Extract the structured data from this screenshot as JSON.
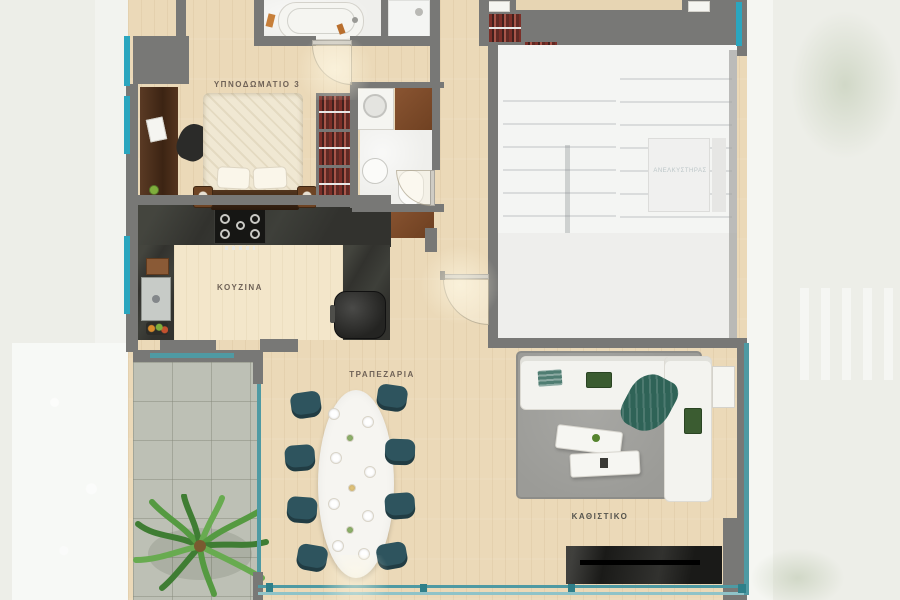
{
  "rooms": {
    "bedroom3": {
      "label": "ΥΠΝΟΔΩΜΑΤΙΟ 3"
    },
    "kitchen": {
      "label": "ΚΟΥΖΙΝΑ"
    },
    "dining": {
      "label": "ΤΡΑΠΕΖΑΡΙΑ"
    },
    "living": {
      "label": "ΚΑΘΙΣΤΙΚΟ"
    },
    "elevator": {
      "label": "ΑΝΕΛΚΥΣΤΗΡΑΣ"
    }
  },
  "colors": {
    "wood_floor": "#ebd9b8",
    "wall_gray": "#787876",
    "window_teal": "#2ba6bf",
    "window_teal_muted": "#4f9aa3",
    "kitchen_counter": "#2e2e2a",
    "dining_chair_teal": "#2e545e",
    "rug_gray": "#9b9b97",
    "terrace_tile": "#bdc0b5",
    "pool_water": "#dcedf2",
    "outside_ground": "#edeee8",
    "wardrobe_clothes_red": "#8e3c36",
    "dark_wood": "#5a3a24",
    "label_text": "#6f6257"
  }
}
